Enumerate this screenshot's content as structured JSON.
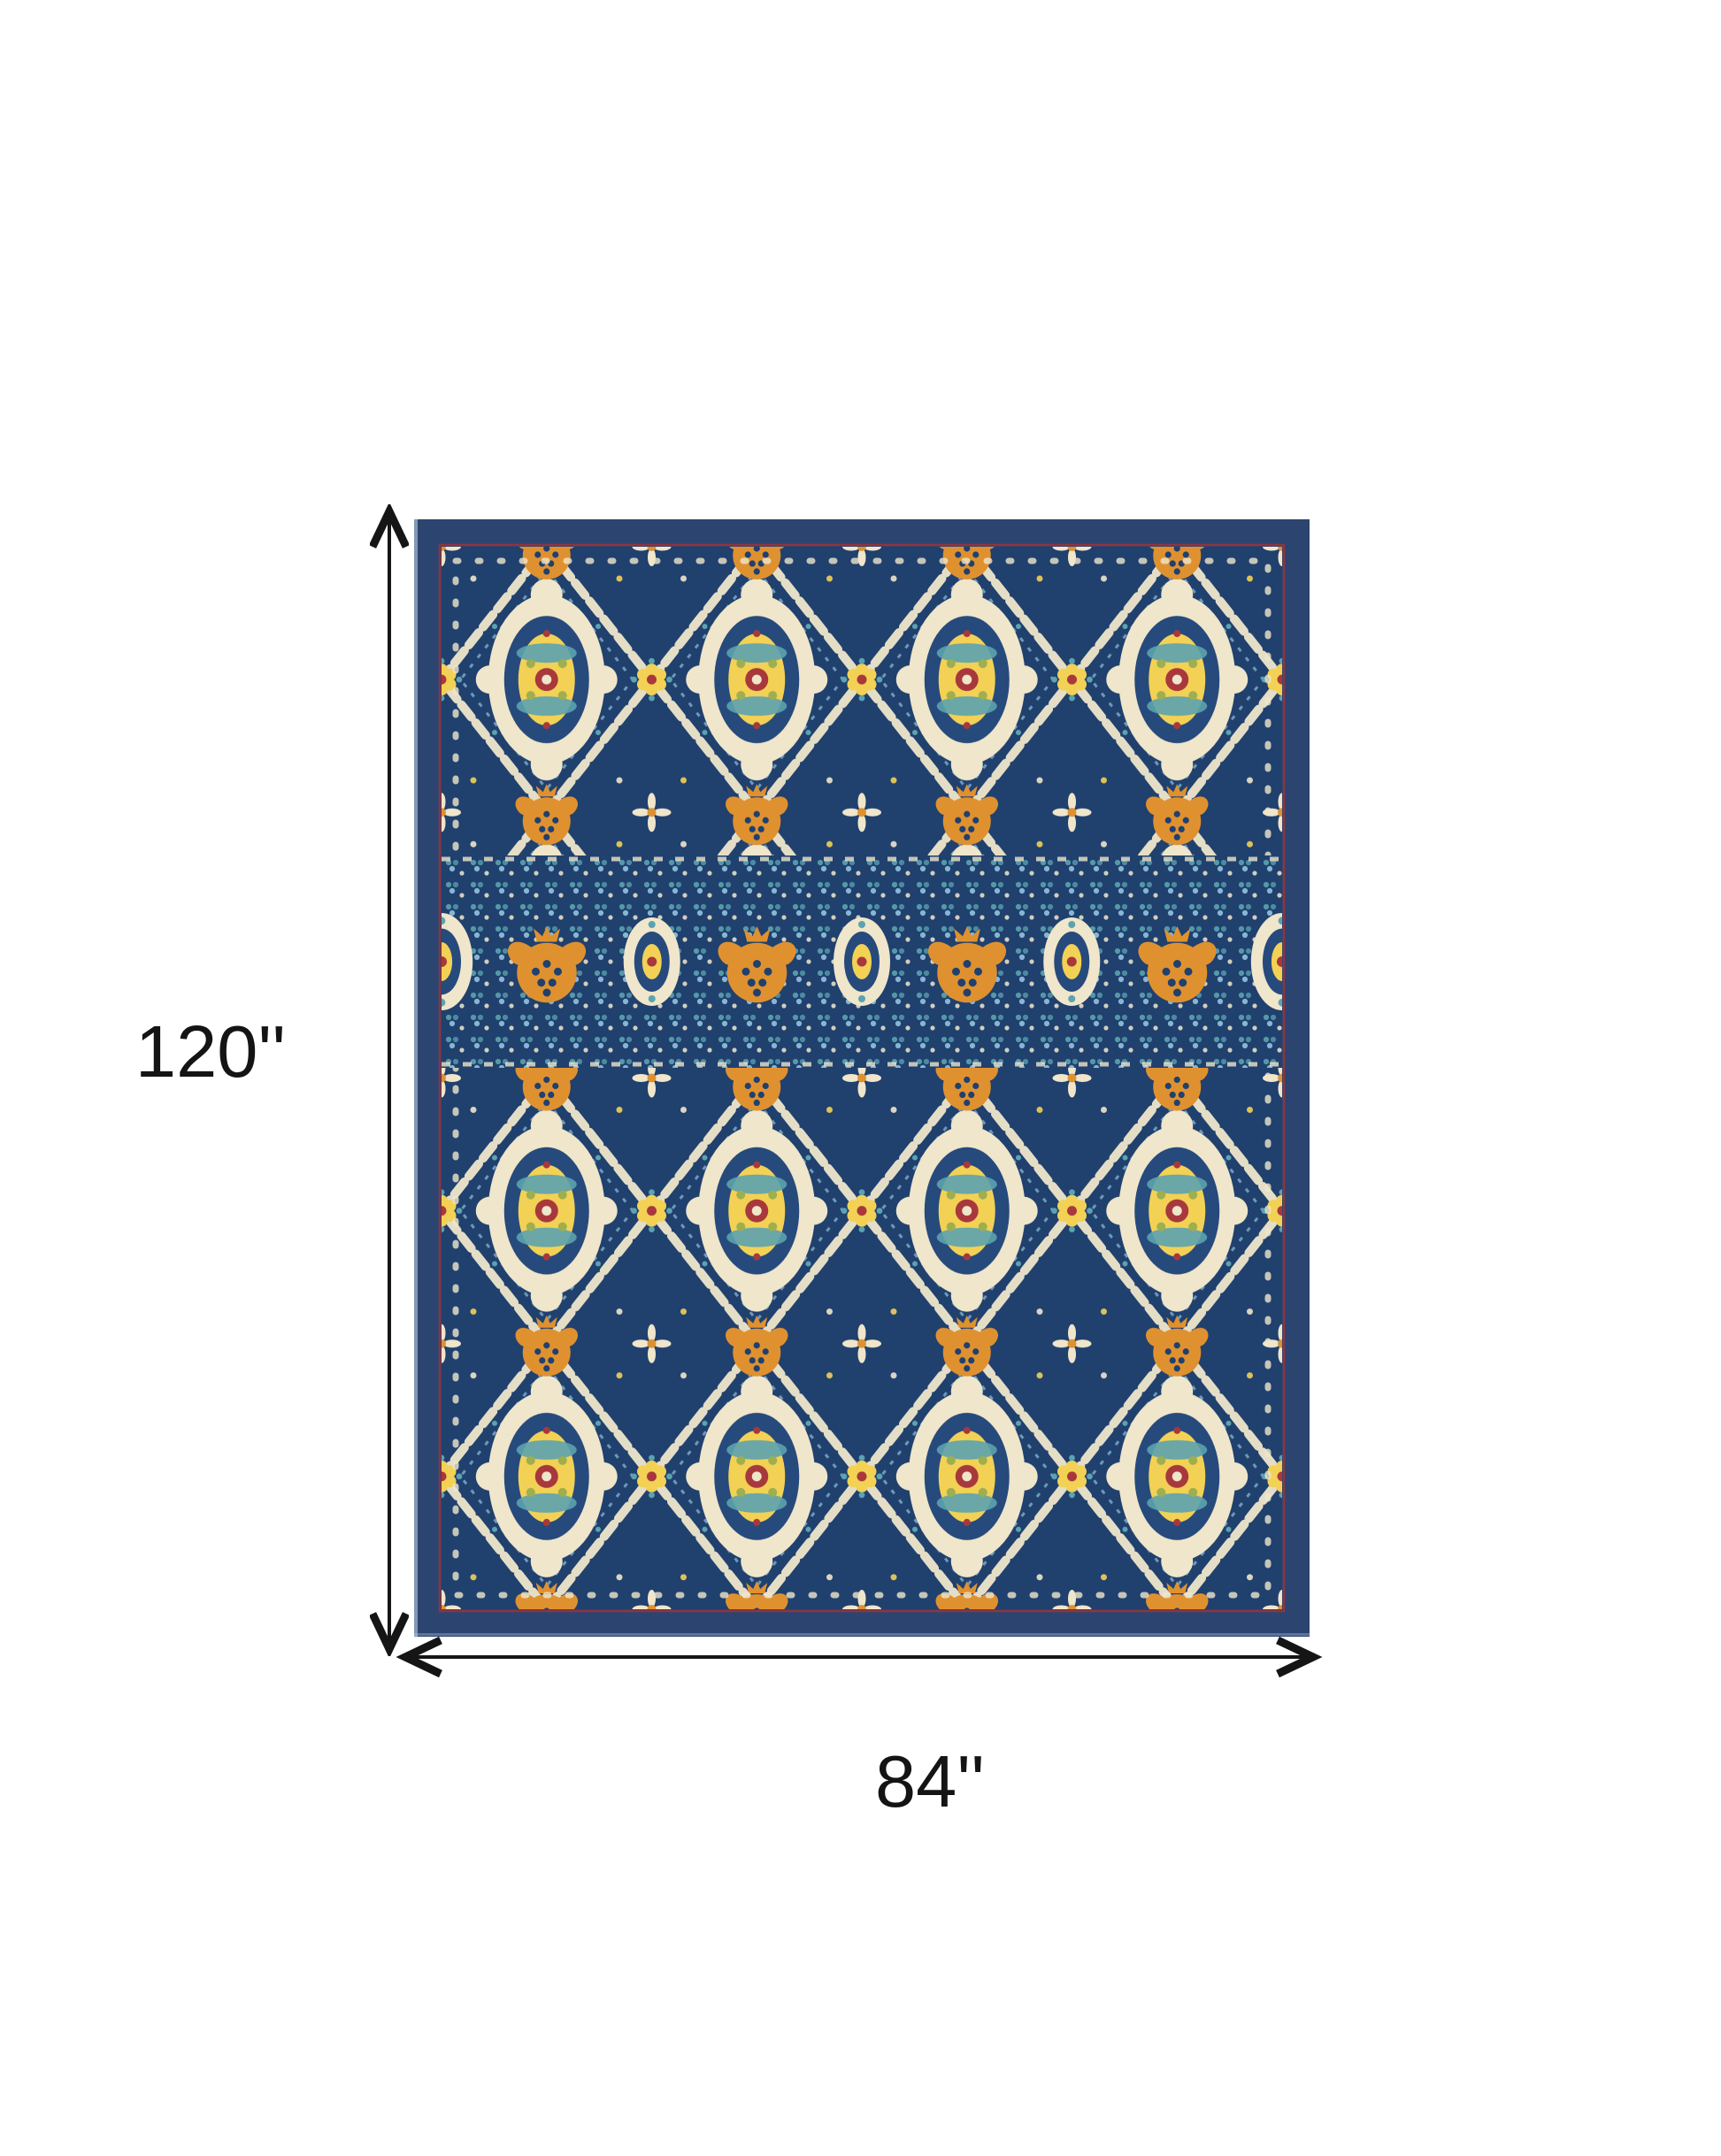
{
  "dimensions": {
    "height_label": "120''",
    "width_label": "84''"
  },
  "figure": {
    "kind": "area-rug-product-photo",
    "style": "persian-floral-medallion",
    "orientation": "portrait"
  },
  "palette": {
    "canvas-bg": "#ffffff",
    "dim-line": "#151515",
    "label-text": "#141414",
    "rug-border-navy": "#2c4470",
    "rug-edge-highlight": "#bcd0e4",
    "rug-maroon": "#8e3440",
    "rug-field-navy": "#20406e",
    "rug-inner-navy": "#274a7c",
    "rug-cream": "#efe6cb",
    "rug-orange": "#df9130",
    "rug-yellow": "#f2d155",
    "rug-teal": "#5ba3b0",
    "rug-light-blue": "#86b6d4",
    "rug-red": "#a8383b",
    "rug-green": "#9fae4e"
  }
}
